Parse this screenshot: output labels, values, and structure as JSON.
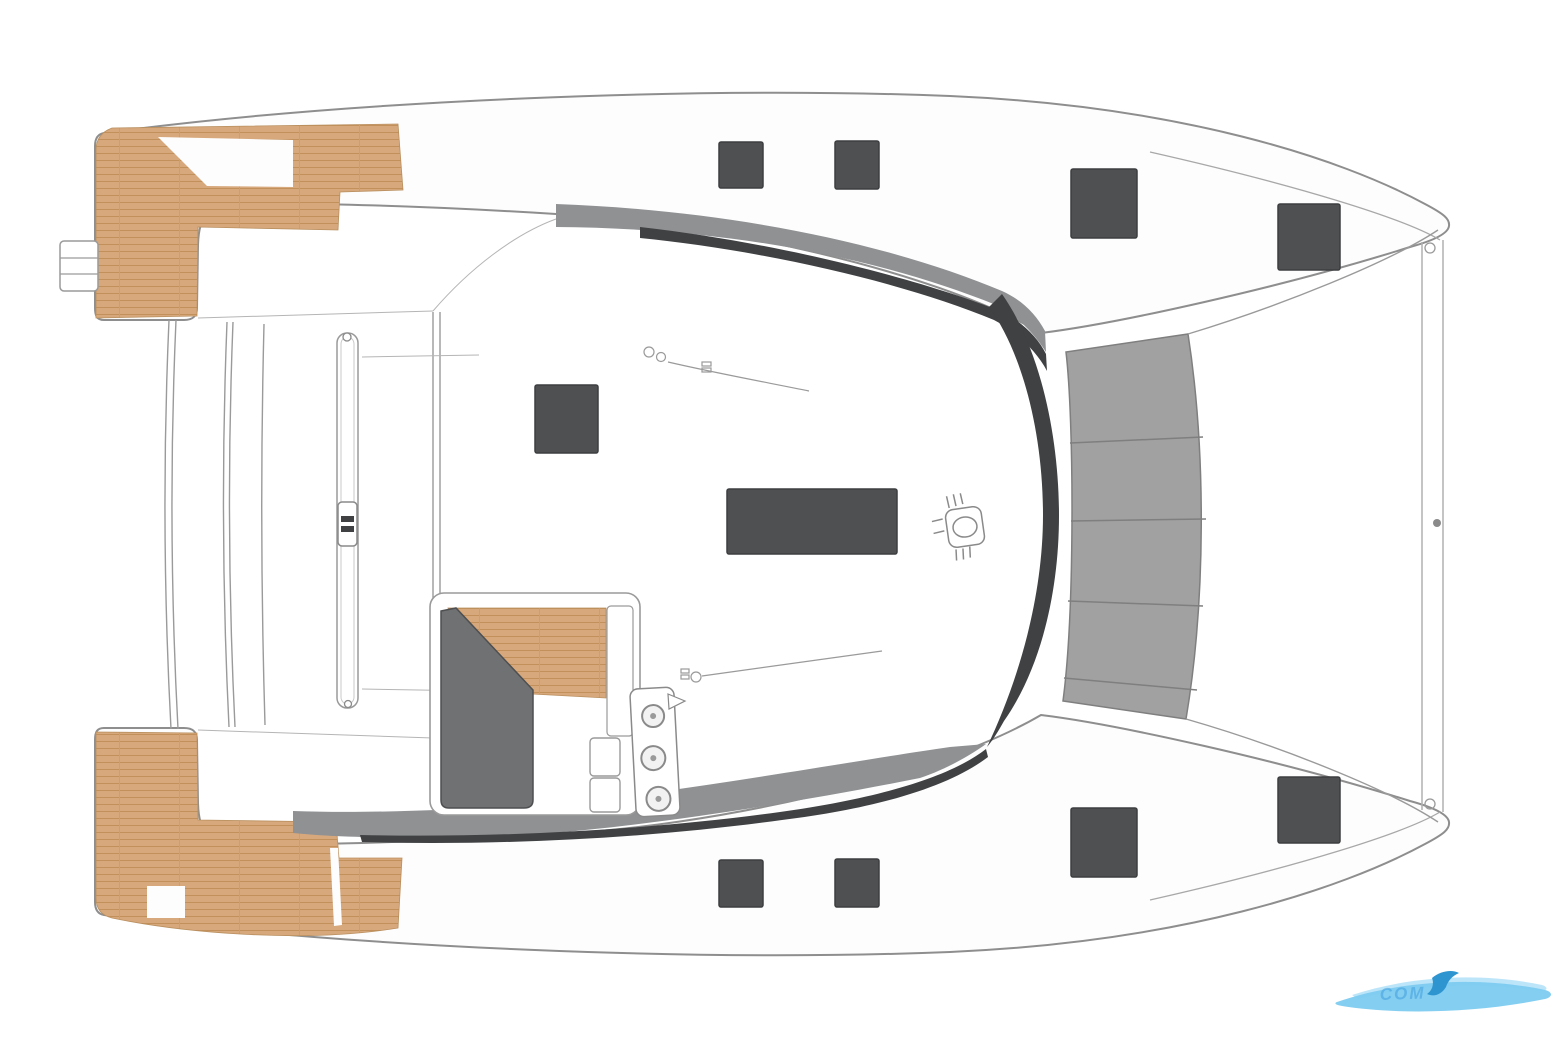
{
  "page": {
    "background": "#ffffff",
    "description": "Catamaran deck layout plan, top view, bow to the right"
  },
  "watermark": {
    "text": "COM"
  },
  "colors": {
    "outline": "#8e8e8e",
    "thin_line": "#9a9a9a",
    "teak": "#d7a87c",
    "teak_stripe": "#c2905a",
    "band_gray": "#8f9193",
    "edge_dark": "#3f4143",
    "trampoline": "#a1a1a1",
    "trampoline_seam": "#7f7f7f",
    "hatch": "#4e5052",
    "hatch_border": "#3c3e40",
    "seat_dark": "#6f7173",
    "watermark_blue": "#7ccbf0",
    "watermark_blue_light": "#b5e2f8",
    "watermark_blue_dark": "#2f95d0"
  },
  "deck": {
    "hatches": [
      {
        "id": "port-hull-aft-hatch",
        "x": 719,
        "y": 142,
        "w": 44,
        "h": 46
      },
      {
        "id": "port-hull-mid-hatch",
        "x": 835,
        "y": 141,
        "w": 44,
        "h": 48
      },
      {
        "id": "port-foredeck-hatch",
        "x": 1071,
        "y": 169,
        "w": 66,
        "h": 69
      },
      {
        "id": "port-bow-hatch",
        "x": 1278,
        "y": 204,
        "w": 62,
        "h": 66
      },
      {
        "id": "coachroof-hatch",
        "x": 535,
        "y": 385,
        "w": 63,
        "h": 68
      },
      {
        "id": "salon-skylight",
        "x": 727,
        "y": 489,
        "w": 170,
        "h": 65
      },
      {
        "id": "starboard-hull-aft-hatch",
        "x": 719,
        "y": 860,
        "w": 44,
        "h": 47
      },
      {
        "id": "starboard-hull-mid-hatch",
        "x": 835,
        "y": 859,
        "w": 44,
        "h": 48
      },
      {
        "id": "starboard-foredeck-hatch",
        "x": 1071,
        "y": 808,
        "w": 66,
        "h": 69
      },
      {
        "id": "starboard-bow-hatch",
        "x": 1278,
        "y": 777,
        "w": 62,
        "h": 66
      }
    ],
    "trampoline_seams": [
      [
        1070,
        443,
        1203,
        437
      ],
      [
        1071,
        521,
        1206,
        519
      ],
      [
        1068,
        601,
        1203,
        606
      ],
      [
        1064,
        678,
        1197,
        690
      ]
    ]
  }
}
